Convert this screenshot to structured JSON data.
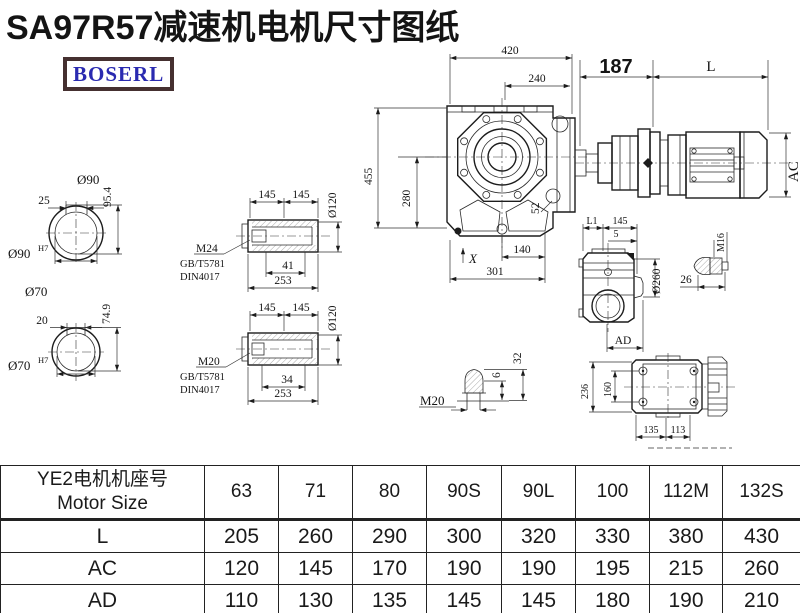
{
  "page": {
    "title": "SA97R57减速机电机尺寸图纸",
    "brand": "BOSERL"
  },
  "dims": {
    "w420": "420",
    "w240": "240",
    "h455": "455",
    "h280": "280",
    "r52": "52",
    "b140": "140",
    "xmark": "X",
    "b301": "301",
    "m187": "187",
    "mL": "L",
    "mAC": "AC",
    "s90_dia": "Ø90",
    "s90_key": "25",
    "s90_h": "95.4",
    "s90_fit": "Ø90",
    "s90_tol": "H7",
    "s70_dia": "Ø70",
    "s70_key": "20",
    "s70_h": "74.9",
    "s70_fit": "Ø70",
    "s70_tol": "H7",
    "ht_145a": "145",
    "ht_145b": "145",
    "ht_dia": "Ø120",
    "ht_bolt": "M24",
    "ht_std1": "GB/T5781",
    "ht_std2": "DIN4017",
    "ht_41": "41",
    "ht_253": "253",
    "hb_145a": "145",
    "hb_145b": "145",
    "hb_dia": "Ø120",
    "hb_bolt": "M20",
    "hb_std1": "GB/T5781",
    "hb_std2": "DIN4017",
    "hb_34": "34",
    "hb_253": "253",
    "sv_L1": "L1",
    "sv_145": "145",
    "sv_5": "5",
    "sv_260": "Ø260",
    "sv_AD": "AD",
    "sv_M16": "M16",
    "sv_26": "26",
    "pl_32": "32",
    "pl_6": "6",
    "pl_M20": "M20",
    "fl_236": "236",
    "fl_160": "160",
    "fl_135": "135",
    "fl_113": "113"
  },
  "table": {
    "header": {
      "cn": "YE2电机机座号",
      "en": "Motor Size"
    },
    "columns": [
      "63",
      "71",
      "80",
      "90S",
      "90L",
      "100",
      "112M",
      "132S"
    ],
    "rows": [
      {
        "label": "L",
        "values": [
          "205",
          "260",
          "290",
          "300",
          "320",
          "330",
          "380",
          "430"
        ]
      },
      {
        "label": "AC",
        "values": [
          "120",
          "145",
          "170",
          "190",
          "190",
          "195",
          "215",
          "260"
        ]
      },
      {
        "label": "AD",
        "values": [
          "110",
          "130",
          "135",
          "145",
          "145",
          "180",
          "190",
          "210"
        ]
      }
    ]
  }
}
